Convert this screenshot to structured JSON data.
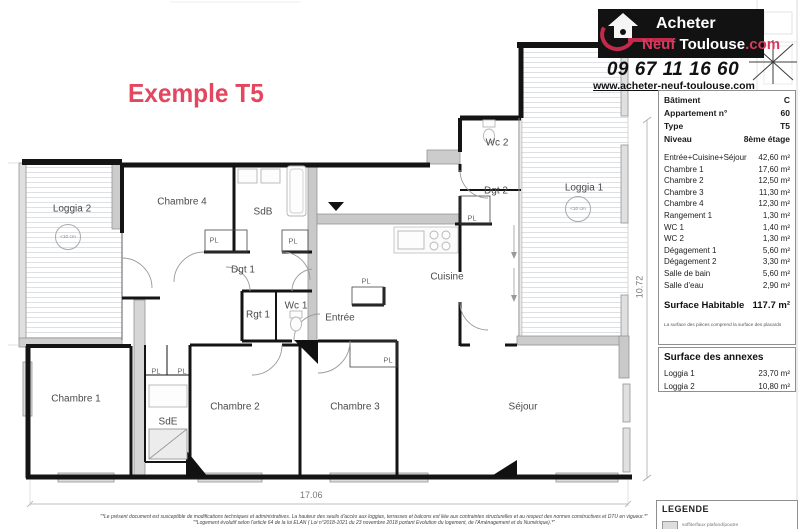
{
  "header": {
    "title": "Exemple T5"
  },
  "brand": {
    "name_line1": "Acheter",
    "name_line2_a": "Neuf",
    "name_line2_b": "Toulouse",
    "name_line2_c": ".com",
    "phone": "09 67 11 16 60",
    "website": "www.acheter-neuf-toulouse.com"
  },
  "info_table": {
    "rows": [
      {
        "label": "Bâtiment",
        "value": "C"
      },
      {
        "label": "Appartement n°",
        "value": "60"
      },
      {
        "label": "Type",
        "value": "T5"
      },
      {
        "label": "Niveau",
        "value": "8ème étage"
      }
    ],
    "areas": [
      {
        "label": "Entrée+Cuisine+Séjour",
        "value": "42,60 m²"
      },
      {
        "label": "Chambre 1",
        "value": "17,60 m²"
      },
      {
        "label": "Chambre 2",
        "value": "12,50 m²"
      },
      {
        "label": "Chambre 3",
        "value": "11,30 m²"
      },
      {
        "label": "Chambre 4",
        "value": "12,30 m²"
      },
      {
        "label": "Rangement 1",
        "value": "1,30 m²"
      },
      {
        "label": "WC 1",
        "value": "1,40 m²"
      },
      {
        "label": "WC 2",
        "value": "1,30 m²"
      },
      {
        "label": "Dégagement 1",
        "value": "5,60 m²"
      },
      {
        "label": "Dégagement 2",
        "value": "3,30 m²"
      },
      {
        "label": "Salle de bain",
        "value": "5,60 m²"
      },
      {
        "label": "Salle d'eau",
        "value": "2,90 m²"
      }
    ],
    "total": {
      "label": "Surface Habitable",
      "value": "117.7 m²"
    },
    "note": "La surface des pièces comprend la surface des placards"
  },
  "annexes": {
    "title": "Surface des annexes",
    "rows": [
      {
        "label": "Loggia 1",
        "value": "23,70 m²"
      },
      {
        "label": "Loggia 2",
        "value": "10,80 m²"
      }
    ]
  },
  "legend": {
    "title": "LEGENDE",
    "item": "soffite/faux plafond/poutre"
  },
  "plan": {
    "rooms": {
      "loggia2": "Loggia 2",
      "loggia1": "Loggia 1",
      "chambre4": "Chambre 4",
      "sdb": "SdB",
      "dgt1": "Dgt 1",
      "wc2": "Wc 2",
      "dgt2": "Dgt 2",
      "cuisine": "Cuisine",
      "rgt1": "Rgt 1",
      "wc1": "Wc 1",
      "entree": "Entrée",
      "chambre1": "Chambre 1",
      "sde": "SdE",
      "chambre2": "Chambre 2",
      "chambre3": "Chambre 3",
      "sejour": "Séjour"
    },
    "closet": "PL",
    "threshold": "<10 cm",
    "dim_width": "17.06",
    "dim_height": "10.72"
  },
  "footnotes": {
    "line1": "\"*Le présent document est susceptible de modifications techniques et administratives. La hauteur des seuils d'accès aux loggias, terrasses et balcons est liée aux contraintes structurelles et au respect des normes constructives et DTU en vigueur.*\"",
    "line2": "\"*Logement évolutif selon l'article 64 de la loi ELAN ( Loi n°2018-1021 du 23 novembre 2018 portant Evolution du logement, de l'Aménagement et du Numérique).*\""
  }
}
